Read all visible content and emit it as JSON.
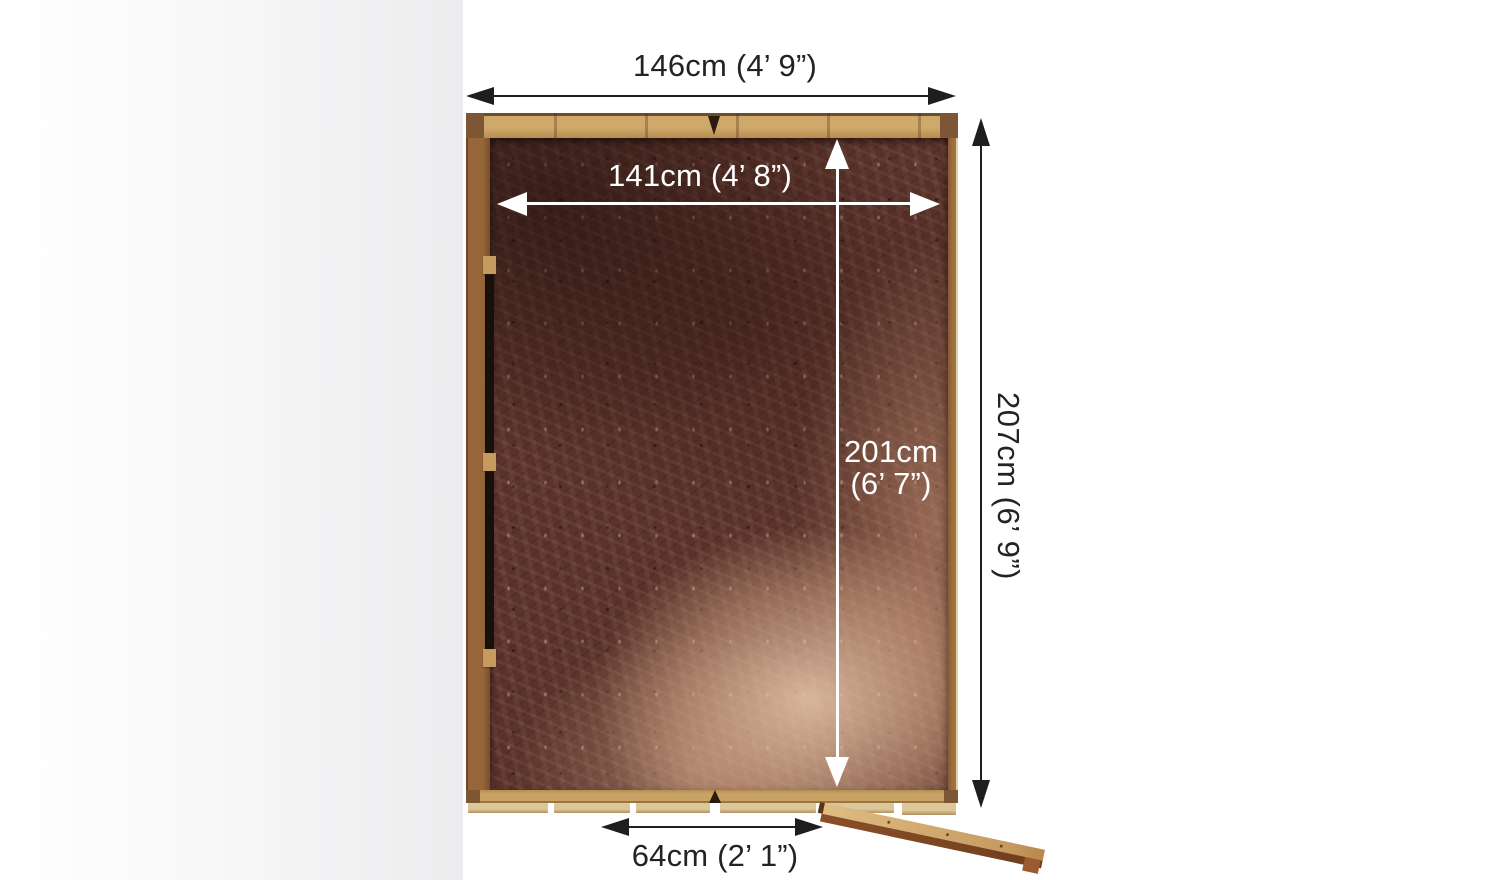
{
  "product_diagram": {
    "title": "Shed floor top view with dimensions",
    "dimensions": {
      "external_width": "146cm (4’ 9”)",
      "internal_width": "141cm (4’ 8”)",
      "internal_depth_value": "201cm",
      "internal_depth_imperial": "(6’ 7”)",
      "external_depth": "207cm (6’ 9”)",
      "door_width": "64cm (2’ 1”)"
    },
    "colors": {
      "annotation_dark": "#1e1e1e",
      "annotation_light": "#ffffff",
      "frame_wood": "#c9a266",
      "floor_dark": "#4a2721",
      "floor_light": "#e9c6a0",
      "background": "#ffffff"
    }
  }
}
